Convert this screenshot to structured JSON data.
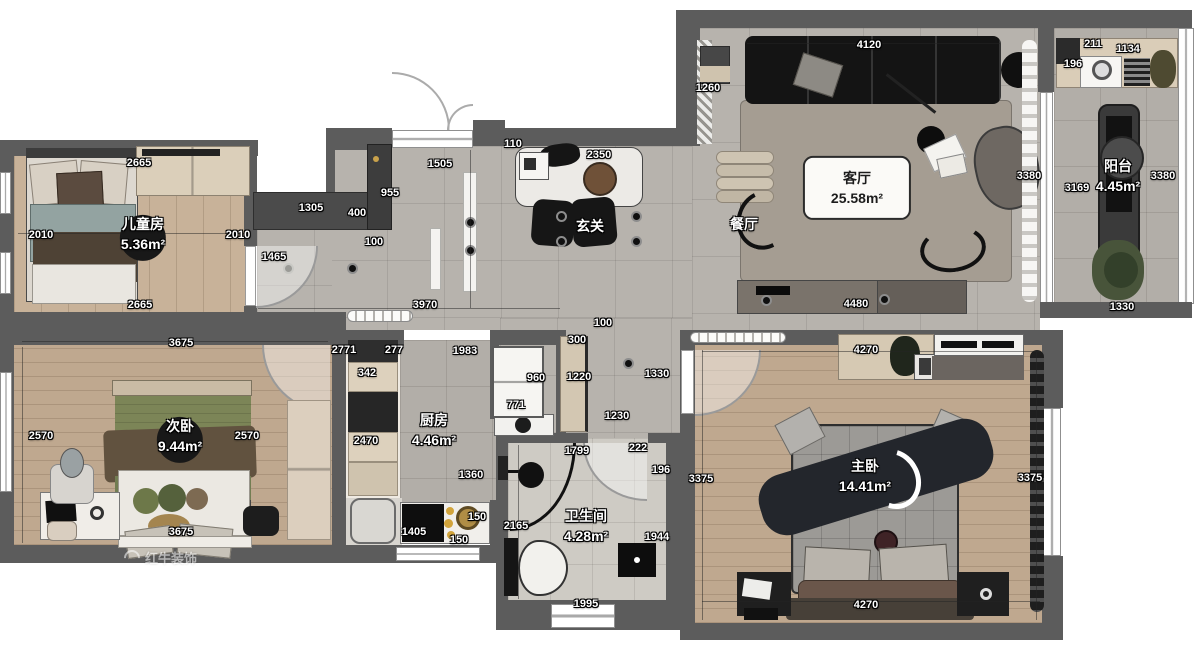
{
  "palette": {
    "wall": "#5c5c5c",
    "tile": "#b7b3ad",
    "wood": "#c1a78d",
    "furniture_black": "#141414",
    "cabinet_beige": "#d8cbb6",
    "plant_green": "#4e5a3a",
    "brass_gold": "#c9a24b"
  },
  "watermark": {
    "text": "红牛装饰",
    "logo": "bull-horn"
  },
  "rooms": [
    {
      "id": "children-room",
      "name": "儿童房",
      "area": "5.36m²",
      "x": 143,
      "y": 234,
      "style": "badge"
    },
    {
      "id": "second-bedroom",
      "name": "次卧",
      "area": "9.44m²",
      "x": 180,
      "y": 436,
      "style": "badge"
    },
    {
      "id": "kitchen",
      "name": "厨房",
      "area": "4.46m²",
      "x": 434,
      "y": 430,
      "style": ""
    },
    {
      "id": "bathroom",
      "name": "卫生间",
      "area": "4.28m²",
      "x": 586,
      "y": 526,
      "style": ""
    },
    {
      "id": "foyer",
      "name": "玄关",
      "area": "",
      "x": 590,
      "y": 226,
      "style": ""
    },
    {
      "id": "dining-room",
      "name": "餐厅",
      "area": "",
      "x": 744,
      "y": 224,
      "style": ""
    },
    {
      "id": "living-room",
      "name": "客厅",
      "area": "25.58m²",
      "x": 857,
      "y": 188,
      "style": "card"
    },
    {
      "id": "master-bedroom",
      "name": "主卧",
      "area": "14.41m²",
      "x": 865,
      "y": 476,
      "style": ""
    },
    {
      "id": "balcony",
      "name": "阳台",
      "area": "4.45m²",
      "x": 1118,
      "y": 176,
      "style": ""
    }
  ],
  "dimensions": [
    {
      "t": "2665",
      "x": 139,
      "y": 163
    },
    {
      "t": "2010",
      "x": 41,
      "y": 235
    },
    {
      "t": "2010",
      "x": 238,
      "y": 235
    },
    {
      "t": "1465",
      "x": 274,
      "y": 257
    },
    {
      "t": "2665",
      "x": 140,
      "y": 305
    },
    {
      "t": "3970",
      "x": 425,
      "y": 305
    },
    {
      "t": "1305",
      "x": 311,
      "y": 208
    },
    {
      "t": "400",
      "x": 357,
      "y": 213
    },
    {
      "t": "955",
      "x": 390,
      "y": 193
    },
    {
      "t": "100",
      "x": 374,
      "y": 242
    },
    {
      "t": "1505",
      "x": 440,
      "y": 164
    },
    {
      "t": "110",
      "x": 513,
      "y": 144
    },
    {
      "t": "2350",
      "x": 599,
      "y": 155
    },
    {
      "t": "100",
      "x": 603,
      "y": 323
    },
    {
      "t": "300",
      "x": 577,
      "y": 340
    },
    {
      "t": "1220",
      "x": 579,
      "y": 377
    },
    {
      "t": "1330",
      "x": 657,
      "y": 374
    },
    {
      "t": "1230",
      "x": 617,
      "y": 416
    },
    {
      "t": "1260",
      "x": 708,
      "y": 88
    },
    {
      "t": "4120",
      "x": 869,
      "y": 45
    },
    {
      "t": "4480",
      "x": 856,
      "y": 304
    },
    {
      "t": "3380",
      "x": 1029,
      "y": 176
    },
    {
      "t": "3169",
      "x": 1077,
      "y": 188
    },
    {
      "t": "3380",
      "x": 1163,
      "y": 176
    },
    {
      "t": "211",
      "x": 1093,
      "y": 44
    },
    {
      "t": "1134",
      "x": 1128,
      "y": 49
    },
    {
      "t": "196",
      "x": 1073,
      "y": 64
    },
    {
      "t": "1330",
      "x": 1122,
      "y": 307
    },
    {
      "t": "4270",
      "x": 866,
      "y": 350
    },
    {
      "t": "4270",
      "x": 866,
      "y": 605
    },
    {
      "t": "3375",
      "x": 701,
      "y": 479
    },
    {
      "t": "3375",
      "x": 1030,
      "y": 478
    },
    {
      "t": "2771",
      "x": 344,
      "y": 350
    },
    {
      "t": "277",
      "x": 394,
      "y": 350
    },
    {
      "t": "1983",
      "x": 465,
      "y": 351
    },
    {
      "t": "342",
      "x": 367,
      "y": 373
    },
    {
      "t": "960",
      "x": 536,
      "y": 378
    },
    {
      "t": "771",
      "x": 516,
      "y": 405
    },
    {
      "t": "2470",
      "x": 366,
      "y": 441
    },
    {
      "t": "1360",
      "x": 471,
      "y": 475
    },
    {
      "t": "1405",
      "x": 414,
      "y": 532
    },
    {
      "t": "150",
      "x": 477,
      "y": 517
    },
    {
      "t": "150",
      "x": 459,
      "y": 540
    },
    {
      "t": "2165",
      "x": 516,
      "y": 526
    },
    {
      "t": "1799",
      "x": 577,
      "y": 451
    },
    {
      "t": "222",
      "x": 638,
      "y": 448
    },
    {
      "t": "196",
      "x": 661,
      "y": 470
    },
    {
      "t": "1944",
      "x": 657,
      "y": 537
    },
    {
      "t": "1995",
      "x": 586,
      "y": 604
    },
    {
      "t": "2570",
      "x": 41,
      "y": 436
    },
    {
      "t": "2570",
      "x": 247,
      "y": 436
    },
    {
      "t": "3675",
      "x": 181,
      "y": 343
    },
    {
      "t": "3675",
      "x": 181,
      "y": 532
    }
  ]
}
